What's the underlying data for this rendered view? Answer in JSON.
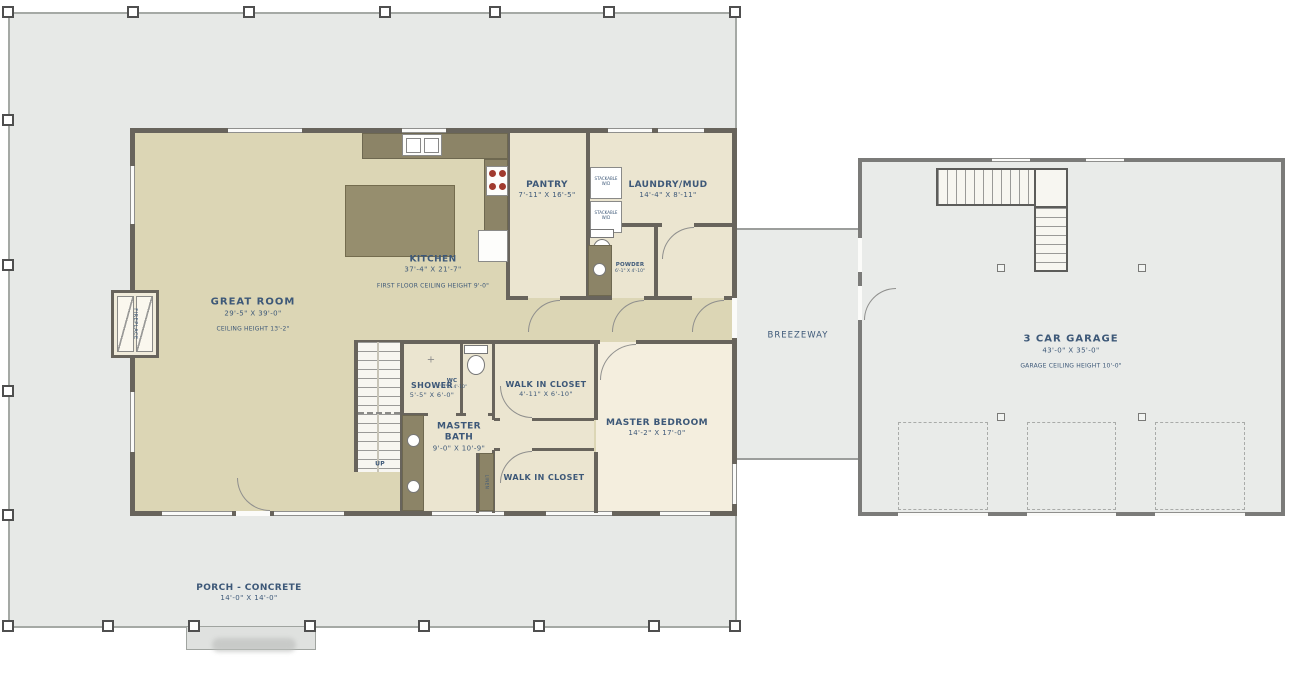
{
  "plan": {
    "title": "First floor plan with 3 car garage",
    "rooms": {
      "great_room": {
        "name": "GREAT ROOM",
        "dims": "29'-5\" X 39'-0\"",
        "note": "CEILING HEIGHT 13'-2\""
      },
      "kitchen": {
        "name": "KITCHEN",
        "dims": "37'-4\" X 21'-7\"",
        "note": "FIRST FLOOR CEILING HEIGHT 9'-0\""
      },
      "pantry": {
        "name": "PANTRY",
        "dims": "7'-11\" X 16'-5\""
      },
      "laundry_mud": {
        "name": "LAUNDRY/MUD",
        "dims": "14'-4\" X 8'-11\""
      },
      "powder": {
        "name": "POWDER",
        "dims": "6'-1\" X 4'-10\""
      },
      "shower": {
        "name": "SHOWER",
        "dims": "5'-5\" X 6'-0\""
      },
      "wc": {
        "name": "WC",
        "dims": "2'-7\" X 4'-10\""
      },
      "master_bath": {
        "name": "MASTER BATH",
        "dims": "9'-0\" X 10'-9\""
      },
      "wic_upper": {
        "name": "WALK IN CLOSET",
        "dims": "4'-11\" X 6'-10\""
      },
      "wic_lower": {
        "name": "WALK IN CLOSET"
      },
      "master_bedroom": {
        "name": "MASTER BEDROOM",
        "dims": "14'-2\" X 17'-0\""
      },
      "breezeway": {
        "name": "BREEZEWAY"
      },
      "garage": {
        "name": "3 CAR GARAGE",
        "dims": "43'-0\" X 35'-0\"",
        "note": "GARAGE CEILING HEIGHT 10'-0\""
      },
      "porch": {
        "name": "PORCH - CONCRETE",
        "dims": "14'-0\" X 14'-0\""
      }
    },
    "annotations": {
      "up": "UP",
      "fireplace": "FIREPLACE",
      "stackable": "STACKABLE W/D",
      "linen": "LINEN"
    },
    "colors": {
      "floor_tan": "#dcd6b5",
      "floor_cream": "#ebe5d0",
      "floor_bedroom": "#f4eede",
      "wall": "#68645c",
      "cabinet": "#8c8467",
      "island": "#968e6e",
      "porch": "#e7e9e7",
      "garage_floor": "#e9ebe9",
      "burner_red": "#a03a2e",
      "label_text": "#3d5878"
    }
  }
}
